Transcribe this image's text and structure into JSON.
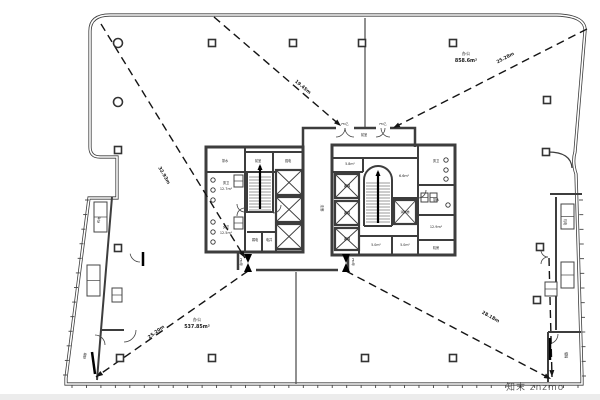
{
  "canvas": {
    "w": 600,
    "h": 400,
    "bg": "#ffffff",
    "bottom_band_color": "#ececec"
  },
  "palette": {
    "wall": "#3d3d3d",
    "thin": "#555555",
    "dash": "#141414",
    "text": "#1a1a1a",
    "watermark": "#8aa0cc"
  },
  "watermark": {
    "text": "知末 znzmo"
  },
  "area_labels": [
    {
      "name": "办公",
      "area": "537.85m²",
      "x": 197,
      "y": 321
    },
    {
      "name": "办公",
      "area": "858.6m²",
      "x": 466,
      "y": 55
    }
  ],
  "egress_lines": [
    {
      "from": [
        101,
        24
      ],
      "to": [
        245,
        258
      ],
      "label": "32.93m",
      "lx": 163,
      "ly": 176,
      "angle": 60
    },
    {
      "from": [
        214,
        17
      ],
      "to": [
        341,
        126
      ],
      "label": "19.45m",
      "lx": 302,
      "ly": 88,
      "angle": 40
    },
    {
      "from": [
        587,
        29
      ],
      "to": [
        393,
        128
      ],
      "label": "25.28m",
      "lx": 506,
      "ly": 59,
      "angle": -28
    },
    {
      "from": [
        248,
        271
      ],
      "to": [
        96,
        377
      ],
      "label": "25.20m",
      "lx": 157,
      "ly": 333,
      "angle": -37
    },
    {
      "from": [
        346,
        271
      ],
      "to": [
        551,
        379
      ],
      "label": "28.18m",
      "lx": 490,
      "ly": 318,
      "angle": 29
    },
    {
      "from": [
        549,
        258
      ],
      "to": [
        552,
        377
      ],
      "label": "",
      "lx": 0,
      "ly": 0,
      "angle": 0
    }
  ],
  "columns": {
    "squares": [
      [
        212,
        43
      ],
      [
        293,
        43
      ],
      [
        362,
        43
      ],
      [
        453,
        43
      ],
      [
        547,
        100
      ],
      [
        546,
        152
      ],
      [
        118,
        150
      ],
      [
        118,
        248
      ],
      [
        117,
        297
      ],
      [
        120,
        358
      ],
      [
        212,
        358
      ],
      [
        365,
        358
      ],
      [
        453,
        358
      ],
      [
        540,
        247
      ],
      [
        537,
        300
      ]
    ],
    "circles": [
      [
        118,
        43
      ],
      [
        118,
        102
      ]
    ]
  },
  "elevators": [
    [
      276,
      170,
      26,
      25
    ],
    [
      276,
      197,
      26,
      25
    ],
    [
      276,
      224,
      26,
      25
    ],
    [
      335,
      174,
      24,
      24
    ],
    [
      335,
      201,
      24,
      24
    ],
    [
      335,
      228,
      24,
      22
    ],
    [
      394,
      200,
      22,
      24
    ]
  ],
  "stairs": [
    {
      "x": 247,
      "y": 174,
      "w": 26,
      "h": 38
    },
    {
      "x": 364,
      "y": 180,
      "w": 28,
      "h": 46
    }
  ],
  "stair_arc": {
    "cx": 378,
    "cy": 180,
    "r": 13
  },
  "labels": [
    [
      "茶水",
      225,
      162,
      3.2,
      0
    ],
    [
      "前室",
      258,
      162,
      3.2,
      0
    ],
    [
      "强电",
      288,
      162,
      3.2,
      0
    ],
    [
      "男卫",
      226,
      184,
      3.2,
      0
    ],
    [
      "12.7m²",
      226,
      190,
      3.4,
      0
    ],
    [
      "女卫",
      226,
      228,
      3.2,
      0
    ],
    [
      "12.5m²",
      226,
      234,
      3.4,
      0
    ],
    [
      "弱电",
      255,
      241,
      3.2,
      0
    ],
    [
      "电井",
      269,
      241,
      3.2,
      0
    ],
    [
      "走廊",
      321,
      208,
      3.4,
      90
    ],
    [
      "前室",
      364,
      136,
      3.2,
      0
    ],
    [
      "FM乙",
      345,
      125,
      3.0,
      0
    ],
    [
      "FM乙",
      383,
      125,
      3.0,
      0
    ],
    [
      "客梯",
      347,
      187,
      3.2,
      0
    ],
    [
      "客梯",
      347,
      214,
      3.2,
      0
    ],
    [
      "客梯",
      347,
      240,
      3.2,
      0
    ],
    [
      "5.8m²",
      350,
      165,
      3.2,
      0
    ],
    [
      "6.6m²",
      404,
      177,
      3.4,
      0
    ],
    [
      "消防梯",
      405,
      213,
      3.0,
      0
    ],
    [
      "男卫",
      436,
      162,
      3.2,
      0
    ],
    [
      "茶水",
      436,
      201,
      3.2,
      0
    ],
    [
      "12.9m²",
      436,
      228,
      3.4,
      0
    ],
    [
      "机房",
      436,
      249,
      3.2,
      0
    ],
    [
      "5.0m²",
      376,
      246,
      3.2,
      0
    ],
    [
      "5.0m²",
      405,
      246,
      3.2,
      0
    ],
    [
      "楼梯",
      565,
      355,
      3.2,
      90
    ],
    [
      "疏散",
      86,
      356,
      3.2,
      -82
    ],
    [
      "机电",
      564,
      222,
      3.2,
      90
    ],
    [
      "机电",
      100,
      220,
      3.2,
      -82
    ],
    [
      "FM甲",
      240,
      262,
      3.0,
      90
    ],
    [
      "FM甲",
      352,
      262,
      3.0,
      90
    ]
  ],
  "mullions": [
    {
      "x1": 89,
      "y1": 200,
      "x2": 67,
      "y2": 375,
      "n": 13,
      "dx": -1,
      "dy": 0,
      "len": 4
    },
    {
      "x1": 579,
      "y1": 200,
      "x2": 582,
      "y2": 376,
      "n": 13,
      "dx": 1,
      "dy": 0,
      "len": 4
    },
    {
      "x1": 72,
      "y1": 385,
      "x2": 578,
      "y2": 385,
      "n": 36,
      "dx": 0,
      "dy": 1,
      "len": 3
    }
  ],
  "fixtures": {
    "dots": [
      [
        213,
        180
      ],
      [
        213,
        190
      ],
      [
        213,
        200
      ],
      [
        213,
        222
      ],
      [
        213,
        232
      ],
      [
        213,
        242
      ],
      [
        446,
        160
      ],
      [
        446,
        170
      ],
      [
        446,
        179
      ],
      [
        448,
        205
      ]
    ],
    "boxes": [
      [
        234,
        175,
        9,
        12
      ],
      [
        234,
        217,
        9,
        12
      ],
      [
        421,
        193,
        7,
        9
      ],
      [
        430,
        193,
        7,
        9
      ],
      [
        112,
        288,
        10,
        14
      ],
      [
        545,
        282,
        12,
        14
      ],
      [
        94,
        202,
        13,
        30
      ],
      [
        87,
        265,
        13,
        31
      ],
      [
        561,
        204,
        13,
        25
      ],
      [
        561,
        262,
        13,
        26
      ]
    ]
  },
  "doors": {
    "arcs": [
      {
        "cx": 245,
        "cy": 204,
        "r": 8,
        "a0": 90,
        "a1": 180
      },
      {
        "cx": 245,
        "cy": 216,
        "r": 8,
        "a0": 180,
        "a1": 270
      },
      {
        "cx": 418,
        "cy": 190,
        "r": 8,
        "a0": 0,
        "a1": 90
      },
      {
        "cx": 273,
        "cy": 205,
        "r": 8,
        "a0": 0,
        "a1": 90
      },
      {
        "cx": 124,
        "cy": 330,
        "r": 12,
        "a0": 0,
        "a1": 90
      },
      {
        "cx": 548,
        "cy": 334,
        "r": 10,
        "a0": 0,
        "a1": 90
      },
      {
        "cx": 95,
        "cy": 345,
        "r": 10,
        "a0": 270,
        "a1": 360
      },
      {
        "cx": 336,
        "cy": 128,
        "r": 9,
        "a0": 0,
        "a1": 90
      },
      {
        "cx": 354,
        "cy": 128,
        "r": 9,
        "a0": 90,
        "a1": 180
      },
      {
        "cx": 376,
        "cy": 128,
        "r": 9,
        "a0": 0,
        "a1": 90
      },
      {
        "cx": 390,
        "cy": 128,
        "r": 9,
        "a0": 90,
        "a1": 180
      },
      {
        "cx": 140,
        "cy": 252,
        "r": 10,
        "a0": 90,
        "a1": 170
      },
      {
        "cx": 548,
        "cy": 250,
        "r": 7,
        "a0": 90,
        "a1": 180
      },
      {
        "cx": 548,
        "cy": 264,
        "r": 7,
        "a0": 180,
        "a1": 270
      }
    ],
    "leaves": [
      [
        92,
        352,
        95,
        374
      ],
      [
        550,
        338,
        550,
        360
      ],
      [
        143,
        252,
        143,
        266
      ]
    ],
    "bowties": [
      [
        248,
        263
      ],
      [
        346,
        263
      ]
    ]
  }
}
